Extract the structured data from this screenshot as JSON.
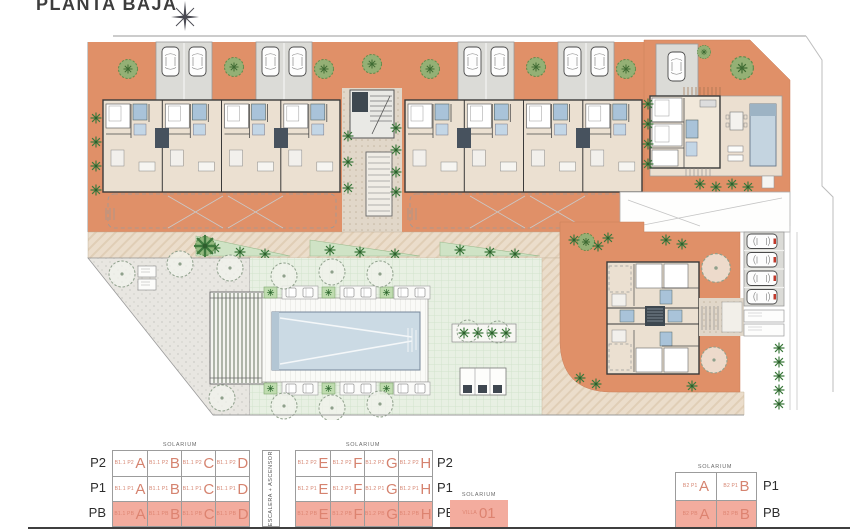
{
  "title": "PLANTA BAJA",
  "icons": {
    "north_arrow": "8-point compass star"
  },
  "colors": {
    "terrace_orange": "#E09068",
    "building_beige": "#EBE0D1",
    "parking_gray": "#DBDBD7",
    "lawn_green": "#E8F0E3",
    "pool_blue": "#CBDAE4",
    "path_beige": "#EBDDCB",
    "accent_salmon": "#D5836F",
    "highlight_salmon": "#F3AC9E"
  },
  "legend": {
    "solarium": "SOLARIUM",
    "stairs": "ESCALERA + ASCENSOR",
    "b11": {
      "rows": [
        {
          "floor": "P2",
          "cells": [
            {
              "code": "B1.1 P2",
              "unit": "A"
            },
            {
              "code": "B1.1 P2",
              "unit": "B"
            },
            {
              "code": "B1.1 P2",
              "unit": "C"
            },
            {
              "code": "B1.1 P2",
              "unit": "D"
            }
          ]
        },
        {
          "floor": "P1",
          "cells": [
            {
              "code": "B1.1 P1",
              "unit": "A"
            },
            {
              "code": "B1.1 P1",
              "unit": "B"
            },
            {
              "code": "B1.1 P1",
              "unit": "C"
            },
            {
              "code": "B1.1 P1",
              "unit": "D"
            }
          ]
        },
        {
          "floor": "PB",
          "cells": [
            {
              "code": "B1.1 PB",
              "unit": "A"
            },
            {
              "code": "B1.1 PB",
              "unit": "B"
            },
            {
              "code": "B1.1 PB",
              "unit": "C"
            },
            {
              "code": "B1.1 PB",
              "unit": "D"
            }
          ]
        }
      ]
    },
    "b12": {
      "rows": [
        {
          "floor": "P2",
          "cells": [
            {
              "code": "B1.2 P2",
              "unit": "E"
            },
            {
              "code": "B1.2 P2",
              "unit": "F"
            },
            {
              "code": "B1.2 P2",
              "unit": "G"
            },
            {
              "code": "B1.2 P2",
              "unit": "H"
            }
          ]
        },
        {
          "floor": "P1",
          "cells": [
            {
              "code": "B1.2 P1",
              "unit": "E"
            },
            {
              "code": "B1.2 P1",
              "unit": "F"
            },
            {
              "code": "B1.2 P1",
              "unit": "G"
            },
            {
              "code": "B1.2 P1",
              "unit": "H"
            }
          ]
        },
        {
          "floor": "PB",
          "cells": [
            {
              "code": "B1.2 PB",
              "unit": "E"
            },
            {
              "code": "B1.2 PB",
              "unit": "F"
            },
            {
              "code": "B1.2 PB",
              "unit": "G"
            },
            {
              "code": "B1.2 PB",
              "unit": "H"
            }
          ]
        }
      ]
    },
    "villa": {
      "code": "VILLA",
      "unit": "01"
    },
    "b2": {
      "rows": [
        {
          "floor": "P1",
          "cells": [
            {
              "code": "B2 P1",
              "unit": "A"
            },
            {
              "code": "B2 P1",
              "unit": "B"
            }
          ]
        },
        {
          "floor": "PB",
          "cells": [
            {
              "code": "B2 PB",
              "unit": "A"
            },
            {
              "code": "B2 PB",
              "unit": "B"
            }
          ]
        }
      ]
    }
  }
}
